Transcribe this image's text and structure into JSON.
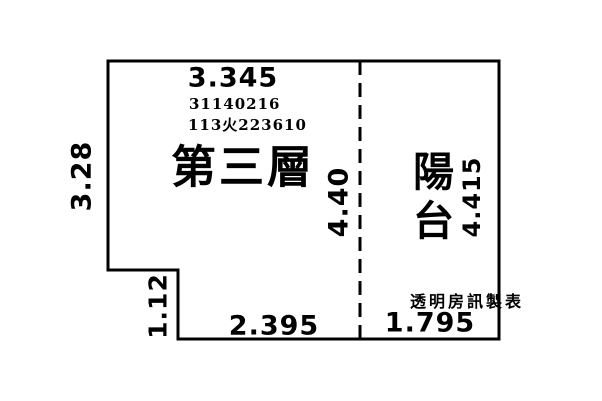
{
  "colors": {
    "background": "#ffffff",
    "ink": "#000000"
  },
  "plan": {
    "floor_label": "第三層",
    "balcony_label": "陽台",
    "registration": {
      "line1": "31140216",
      "line2": "113火223610"
    },
    "watermark": "透明房訊製表",
    "dimensions": {
      "top_width": "3.345",
      "left_height": "3.28",
      "divider_height": "4.40",
      "balcony_height": "4.415",
      "notch_height": "1.12",
      "bottom_left_width": "2.395",
      "bottom_right_width": "1.795"
    }
  }
}
